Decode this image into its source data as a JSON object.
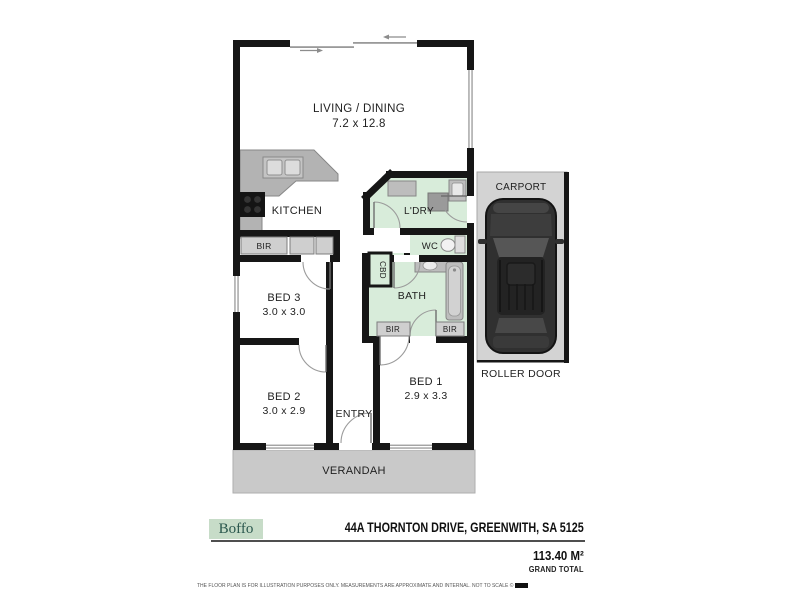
{
  "floorplan": {
    "colors": {
      "wall": "#161616",
      "wet_area_floor": "#d8ecda",
      "verandah_fill": "#c9c9c9",
      "carport_fill": "#d3d3d3",
      "counter_fill": "#b3b3b3",
      "closet_fill": "#cfcfcf",
      "car_body": "#303030"
    },
    "rooms": {
      "living": {
        "name": "LIVING / DINING",
        "dims": "7.2 x 12.8"
      },
      "kitchen": {
        "name": "KITCHEN"
      },
      "laundry": {
        "name": "L'DRY"
      },
      "wc": {
        "name": "WC"
      },
      "bath": {
        "name": "BATH"
      },
      "cupboard": {
        "name": "CBD"
      },
      "bed3": {
        "name": "BED 3",
        "dims": "3.0 x 3.0"
      },
      "bed2": {
        "name": "BED 2",
        "dims": "3.0 x 2.9"
      },
      "bed1": {
        "name": "BED 1",
        "dims": "2.9 x 3.3"
      },
      "entry": {
        "name": "ENTRY"
      },
      "verandah": {
        "name": "VERANDAH"
      },
      "carport": {
        "name": "CARPORT"
      },
      "roller_door": {
        "name": "ROLLER DOOR"
      },
      "robe_bed3": {
        "name": "BIR"
      },
      "robe_bath_left": {
        "name": "BIR"
      },
      "robe_bath_right": {
        "name": "BIR"
      }
    }
  },
  "footer": {
    "brand": "Boffo",
    "address": "44A THORNTON DRIVE, GREENWITH, SA 5125",
    "total_area": "113.40 M²",
    "total_label": "GRAND TOTAL",
    "disclaimer": "THE FLOOR PLAN IS FOR ILLUSTRATION PURPOSES ONLY. MEASUREMENTS ARE APPROXIMATE AND INTERNAL. NOT TO SCALE ©"
  }
}
